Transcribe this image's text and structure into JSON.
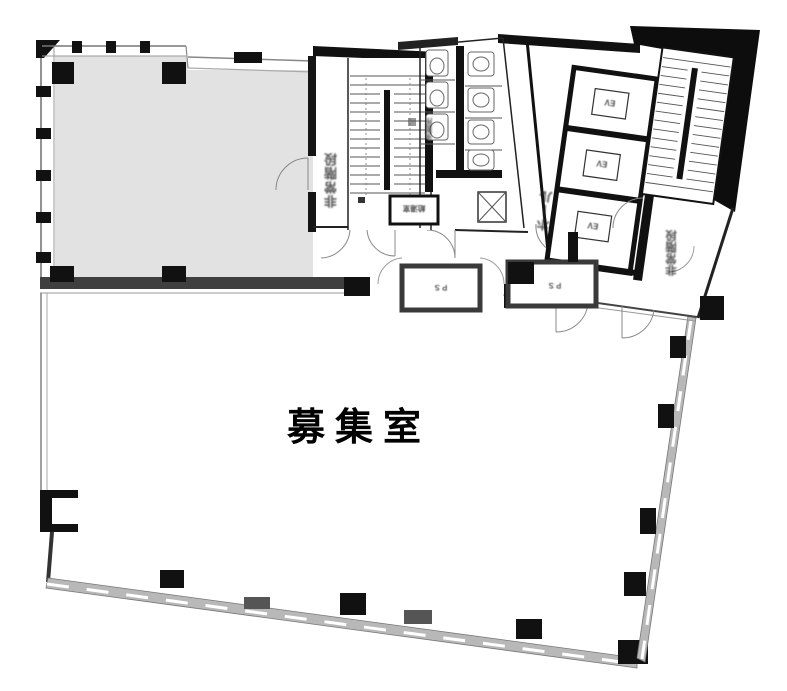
{
  "floor_plan": {
    "main_room": {
      "label": "募集室"
    },
    "labels": {
      "left_stair": "非常階段",
      "right_stair": "非常階段",
      "elevator_hall": "ホール",
      "elevator": "EV",
      "kitchenette": "給湯室",
      "washroom": "洗面所",
      "shaft_left": "ＰＳ",
      "shaft_right": "ＰＳ"
    },
    "colors": {
      "wall": "#111111",
      "vacant_room_fill": "#e2e2e2",
      "window_band": "#b8b8b8",
      "divider_wall": "#3f3f3f",
      "background": "#ffffff"
    }
  }
}
